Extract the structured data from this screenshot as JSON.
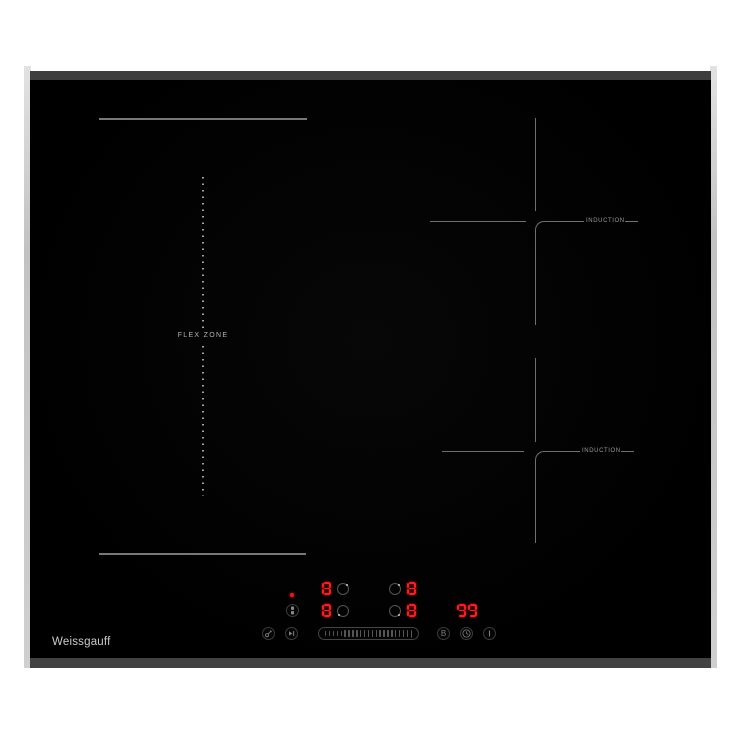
{
  "brand": {
    "logo_text": "Weissgauff"
  },
  "zones": {
    "flex_zone_label": "FLEX ZONE",
    "induction_top_label": "INDUCTION",
    "induction_bottom_label": "INDUCTION"
  },
  "displays": {
    "flex_rear_level": "8",
    "flex_front_level": "8",
    "right_rear_level": "8",
    "right_front_level": "8",
    "timer_value": "99"
  },
  "controls": {
    "power_indicator": "on",
    "boost_label": "B",
    "slider_tick_count": 23,
    "icons": {
      "bridge_button": "flex-bridge-icon",
      "lock_button": "key-lock-icon",
      "pause_button": "pause-icon",
      "boost_button": "letter-B",
      "timer_button": "clock-icon",
      "power_button": "power-bar-icon"
    }
  },
  "colors": {
    "led_red": "#ff1d1d",
    "glass_black": "#000000",
    "chassis_gray": "#3e3e3e",
    "marking_gray": "#787878"
  }
}
